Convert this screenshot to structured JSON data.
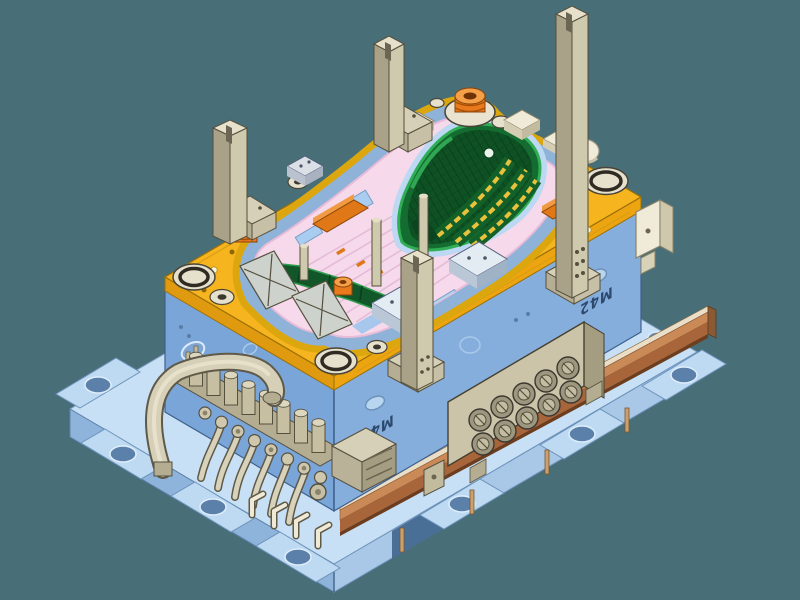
{
  "scene": {
    "description": "Isometric CAD render of a plastic injection mold tool assembly",
    "view": "isometric",
    "background_color": "#486E78"
  },
  "labels": {
    "mold_marking_front": "M42",
    "mold_marking_side": "M42"
  },
  "palette": {
    "top_clamp_plate_yellow": "#F6B41E",
    "plate_side_yellow": "#E09A10",
    "core_block_blue_left": "#7AA5D8",
    "core_block_blue_right": "#85AEDD",
    "bottom_plate_light_blue": "#C8E0F5",
    "parting_surface_pink": "#F6D9EA",
    "channel_blue": "#8FB2D8",
    "cavity_green_dark": "#0E5224",
    "cavity_green": "#156C30",
    "cavity_highlight_green": "#2FAE55",
    "insert_orange": "#E07818",
    "pillar_tan_light": "#CFC9AE",
    "pillar_tan_dark": "#A9A289",
    "rail_copper": "#C98A58",
    "fitting_ivory": "#ECE6D0"
  },
  "counts": {
    "support_pillars": 4,
    "quick_couplers": 10,
    "guide_bushings": 4,
    "manifold_valves": 8
  },
  "parts": [
    {
      "id": "bottom-clamp-plate",
      "label": "bottom clamp plate with clamping slots"
    },
    {
      "id": "core-block",
      "label": "mold core block (M42)"
    },
    {
      "id": "cavity-plate",
      "label": "yellow cavity plate"
    },
    {
      "id": "parting-surface",
      "label": "pink parting surface"
    },
    {
      "id": "cavity-insert",
      "label": "green seat-back cavity insert"
    },
    {
      "id": "side-insert",
      "label": "green side blade insert"
    },
    {
      "id": "locating-ring",
      "label": "orange locating ring"
    },
    {
      "id": "support-pillars",
      "label": "tan support pillars"
    },
    {
      "id": "hydraulic-manifold",
      "label": "hydraulic valve manifold with hoses"
    },
    {
      "id": "coupler-plate",
      "label": "multi-coupler connector plate"
    },
    {
      "id": "heater-rail",
      "label": "copper heater rail"
    }
  ]
}
